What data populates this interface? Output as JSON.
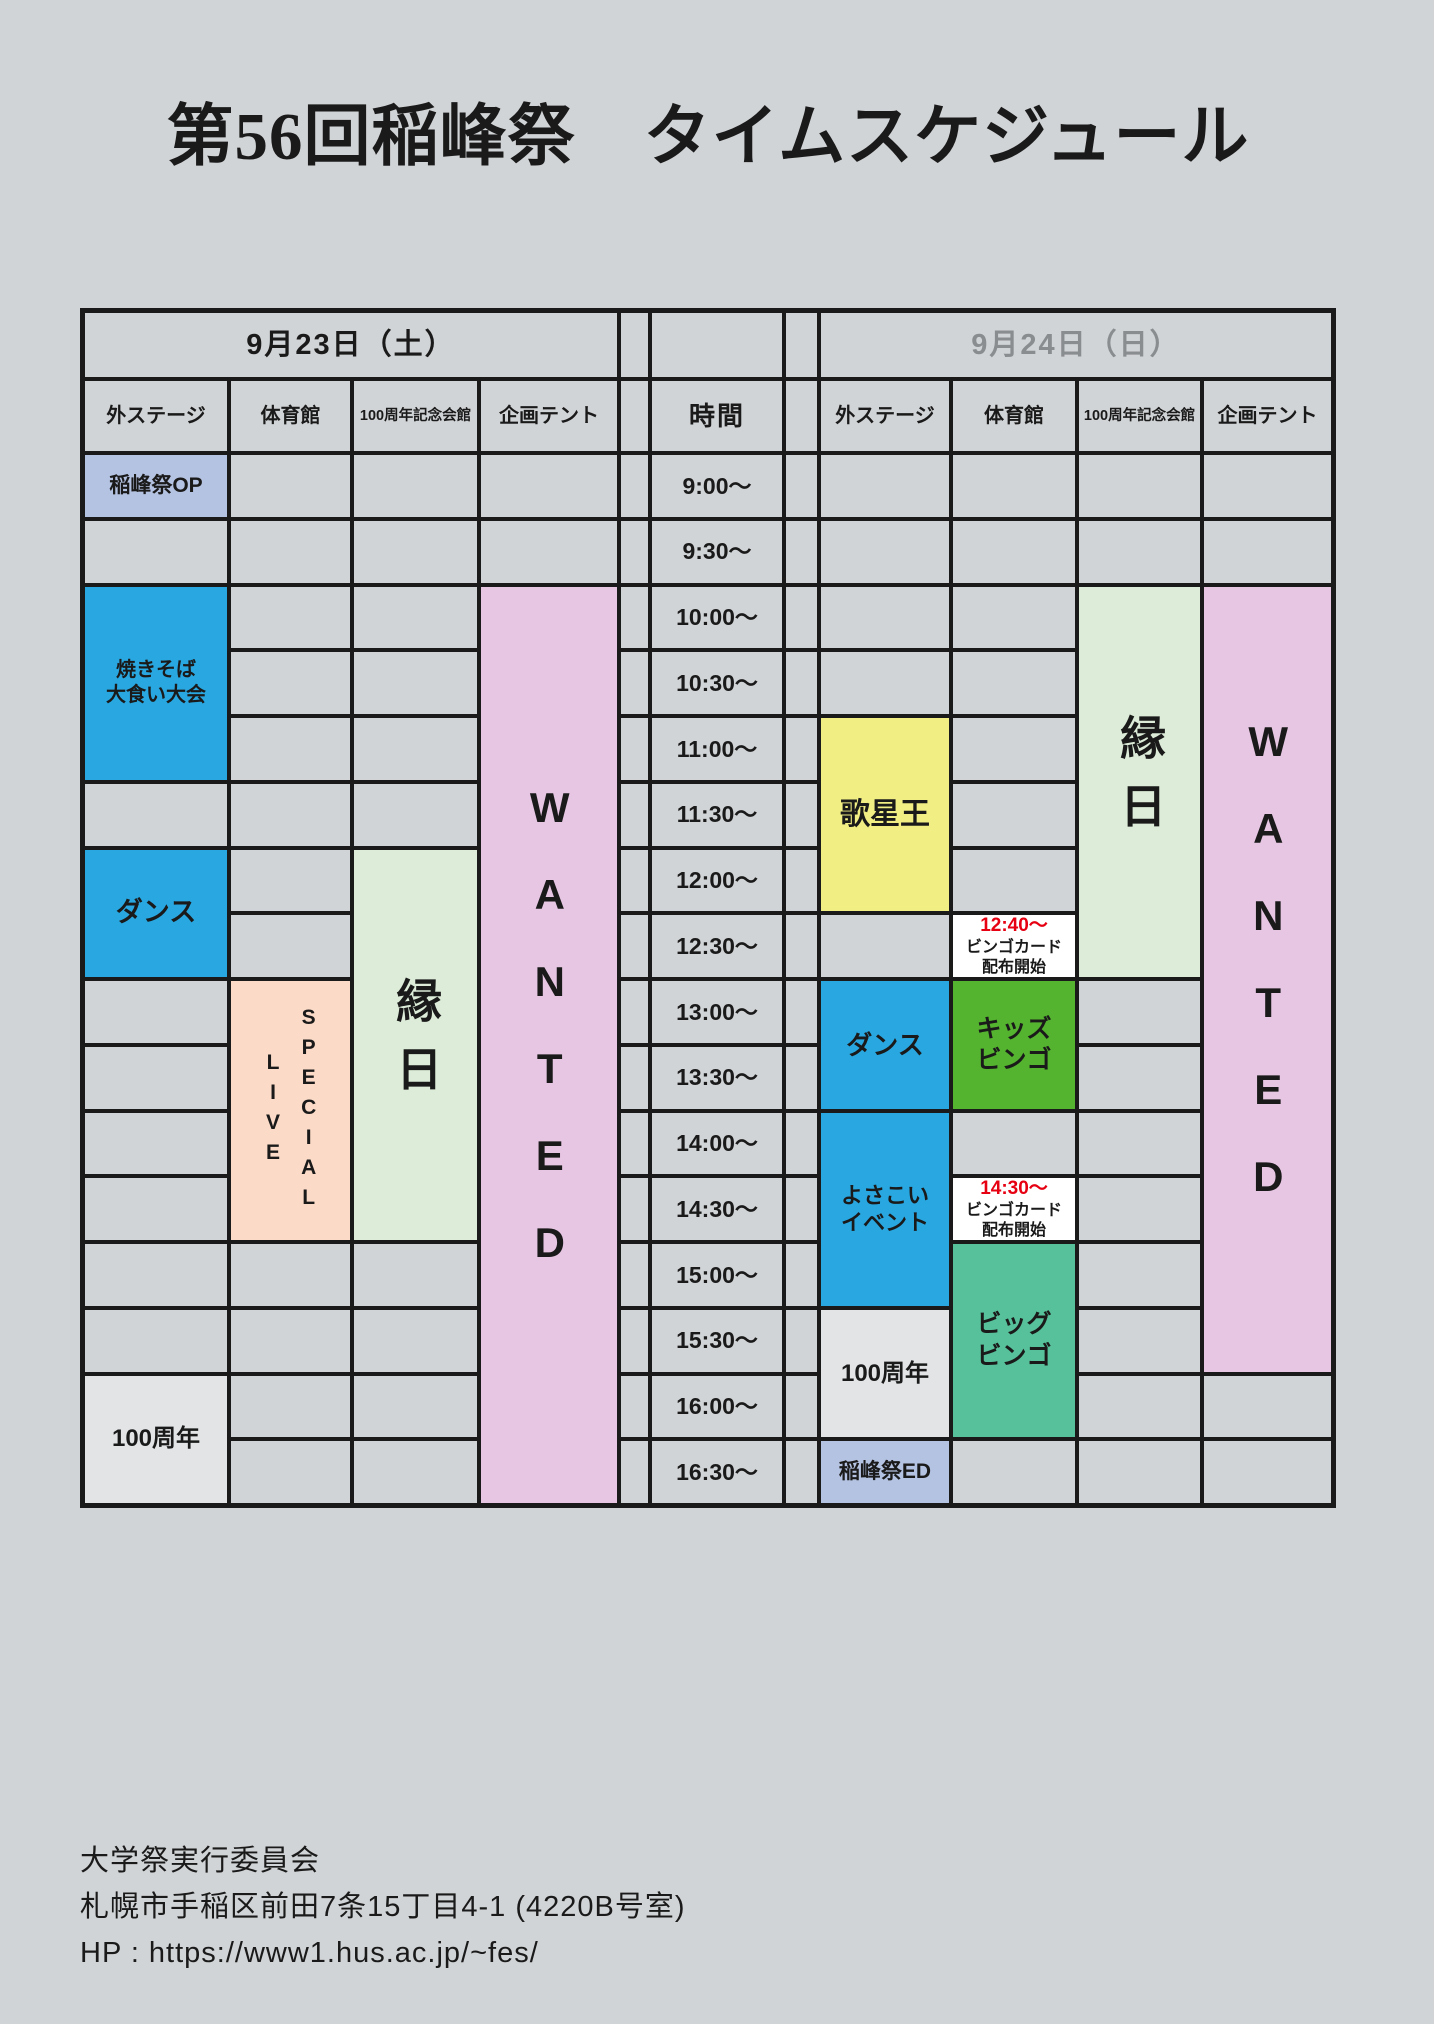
{
  "title": "第56回稲峰祭　タイムスケジュール",
  "table": {
    "day1": {
      "date": "9月23日（土）"
    },
    "day2": {
      "date": "9月24日（日）"
    },
    "time_header": "時間",
    "venues": [
      "外ステージ",
      "体育館",
      "100周年記念会館",
      "企画テント"
    ],
    "times": [
      "9:00～",
      "9:30～",
      "10:00～",
      "10:30～",
      "11:00～",
      "11:30～",
      "12:00～",
      "12:30～",
      "13:00～",
      "13:30～",
      "14:00～",
      "14:30～",
      "15:00～",
      "15:30～",
      "16:00～",
      "16:30～"
    ],
    "events": [
      {
        "id": "inamine-op",
        "day": 1,
        "venue": 0,
        "row": 0,
        "span": 1,
        "lines": [
          "稲峰祭OP"
        ],
        "bg": "periwinkle",
        "size": 21
      },
      {
        "id": "yakisoba-contest",
        "day": 1,
        "venue": 0,
        "row": 2,
        "span": 3,
        "lines": [
          "焼きそば",
          "大食い大会"
        ],
        "bg": "cyan",
        "size": 20
      },
      {
        "id": "dance-sat",
        "day": 1,
        "venue": 0,
        "row": 6,
        "span": 2,
        "lines": [
          "ダンス"
        ],
        "bg": "cyan",
        "size": 27
      },
      {
        "id": "100th-sat",
        "day": 1,
        "venue": 0,
        "row": 14,
        "span": 2,
        "lines": [
          "100周年"
        ],
        "bg": "light_gray",
        "size": 24
      },
      {
        "id": "special-live",
        "day": 1,
        "venue": 1,
        "row": 8,
        "span": 4,
        "vertical": true,
        "lines": [
          "SPECIAL",
          "LIVE"
        ],
        "bg": "peach",
        "size": 21,
        "lspace": 7,
        "lineh": 1.7
      },
      {
        "id": "ennichi-sat",
        "day": 1,
        "venue": 2,
        "row": 6,
        "span": 6,
        "vertical": true,
        "lines": [
          "縁日"
        ],
        "bg": "pale_green",
        "size": 46,
        "lspace": 22
      },
      {
        "id": "wanted-sat",
        "day": 1,
        "venue": 3,
        "row": 2,
        "span": 14,
        "vertical": true,
        "lines": [
          "WANTED"
        ],
        "bg": "pink",
        "size": 42,
        "lspace": 40
      },
      {
        "id": "utaseio",
        "day": 2,
        "venue": 0,
        "row": 4,
        "span": 3,
        "lines": [
          "歌星王"
        ],
        "bg": "yellow",
        "size": 30
      },
      {
        "id": "dance-sun",
        "day": 2,
        "venue": 0,
        "row": 8,
        "span": 2,
        "lines": [
          "ダンス"
        ],
        "bg": "cyan",
        "size": 26
      },
      {
        "id": "yosakoi-event",
        "day": 2,
        "venue": 0,
        "row": 10,
        "span": 3,
        "lines": [
          "よさこい",
          "イベント"
        ],
        "bg": "cyan",
        "size": 22
      },
      {
        "id": "100th-sun",
        "day": 2,
        "venue": 0,
        "row": 13,
        "span": 2,
        "lines": [
          "100周年"
        ],
        "bg": "light_gray",
        "size": 24
      },
      {
        "id": "inamine-ed",
        "day": 2,
        "venue": 0,
        "row": 15,
        "span": 1,
        "lines": [
          "稲峰祭ED"
        ],
        "bg": "periwinkle",
        "size": 21
      },
      {
        "id": "bingo-card-1240",
        "day": 2,
        "venue": 1,
        "row": 7,
        "span": 1,
        "time_red": "12:40～",
        "lines": [
          "ビンゴカード",
          "配布開始"
        ],
        "bg": "white",
        "size": 16
      },
      {
        "id": "kids-bingo",
        "day": 2,
        "venue": 1,
        "row": 8,
        "span": 2,
        "lines": [
          "キッズ",
          "ビンゴ"
        ],
        "bg": "kids_green",
        "size": 25
      },
      {
        "id": "bingo-card-1430",
        "day": 2,
        "venue": 1,
        "row": 11,
        "span": 1,
        "time_red": "14:30～",
        "lines": [
          "ビンゴカード",
          "配布開始"
        ],
        "bg": "white",
        "size": 16
      },
      {
        "id": "big-bingo",
        "day": 2,
        "venue": 1,
        "row": 12,
        "span": 3,
        "lines": [
          "ビッグ",
          "ビンゴ"
        ],
        "bg": "teal",
        "size": 25
      },
      {
        "id": "ennichi-sun",
        "day": 2,
        "venue": 2,
        "row": 2,
        "span": 6,
        "vertical": true,
        "lines": [
          "縁日"
        ],
        "bg": "pale_green",
        "size": 46,
        "lspace": 22
      },
      {
        "id": "wanted-sun",
        "day": 2,
        "venue": 3,
        "row": 2,
        "span": 12,
        "vertical": true,
        "lines": [
          "WANTED"
        ],
        "bg": "pink",
        "size": 42,
        "lspace": 40
      }
    ]
  },
  "footer": {
    "lines": [
      "大学祭実行委員会",
      "札幌市手稲区前田7条15丁目4-1 (4220B号室)",
      "HP : https://www1.hus.ac.jp/~fes/"
    ]
  },
  "colors": {
    "page_bg": "#d1d4d6",
    "grid_line": "#1a1a1a",
    "cell_bg": "#d1d4d6",
    "text_black": "#1a1a1a",
    "day2_gray": "#8a8d90",
    "cyan": "#29a7e1",
    "periwinkle": "#b5c3e2",
    "peach": "#fbdac7",
    "pale_green": "#dcecd8",
    "pink": "#e7c6e3",
    "yellow": "#f1ee83",
    "kids_green": "#55b42f",
    "teal": "#57c19b",
    "white": "#ffffff",
    "light_gray": "#e2e4e6",
    "red": "#e60012"
  }
}
